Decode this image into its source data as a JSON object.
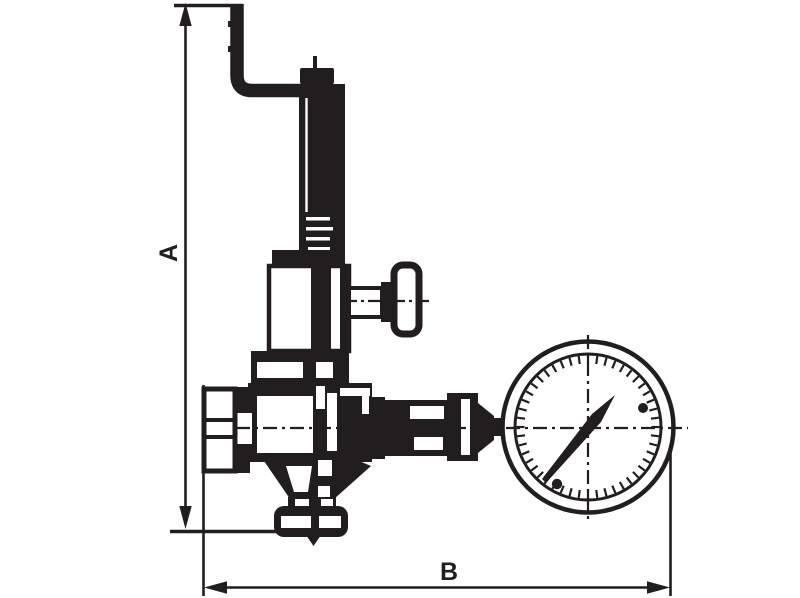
{
  "figure": {
    "type": "technical-dimensional-drawing",
    "subject": "spring-safety-valve-with-pressure-gauge",
    "background_color": "#ffffff",
    "ink_color": "#221e1f",
    "dimension_labels": {
      "height": "A",
      "width": "B"
    },
    "components": {
      "pipe": "bent-discharge-pipe",
      "spring_column": "spring-housing-column",
      "bonnet": "valve-bonnet",
      "side_handle": "side-test-handle",
      "body": "valve-body",
      "inlet": "inlet-hex-connector",
      "outlet": "bottom-outlet-flange",
      "gauge_fitting": "gauge-union-fitting",
      "gauge": "pressure-gauge-dial"
    },
    "gauge": {
      "tick_count": 48,
      "needle_direction": "up-right"
    }
  }
}
